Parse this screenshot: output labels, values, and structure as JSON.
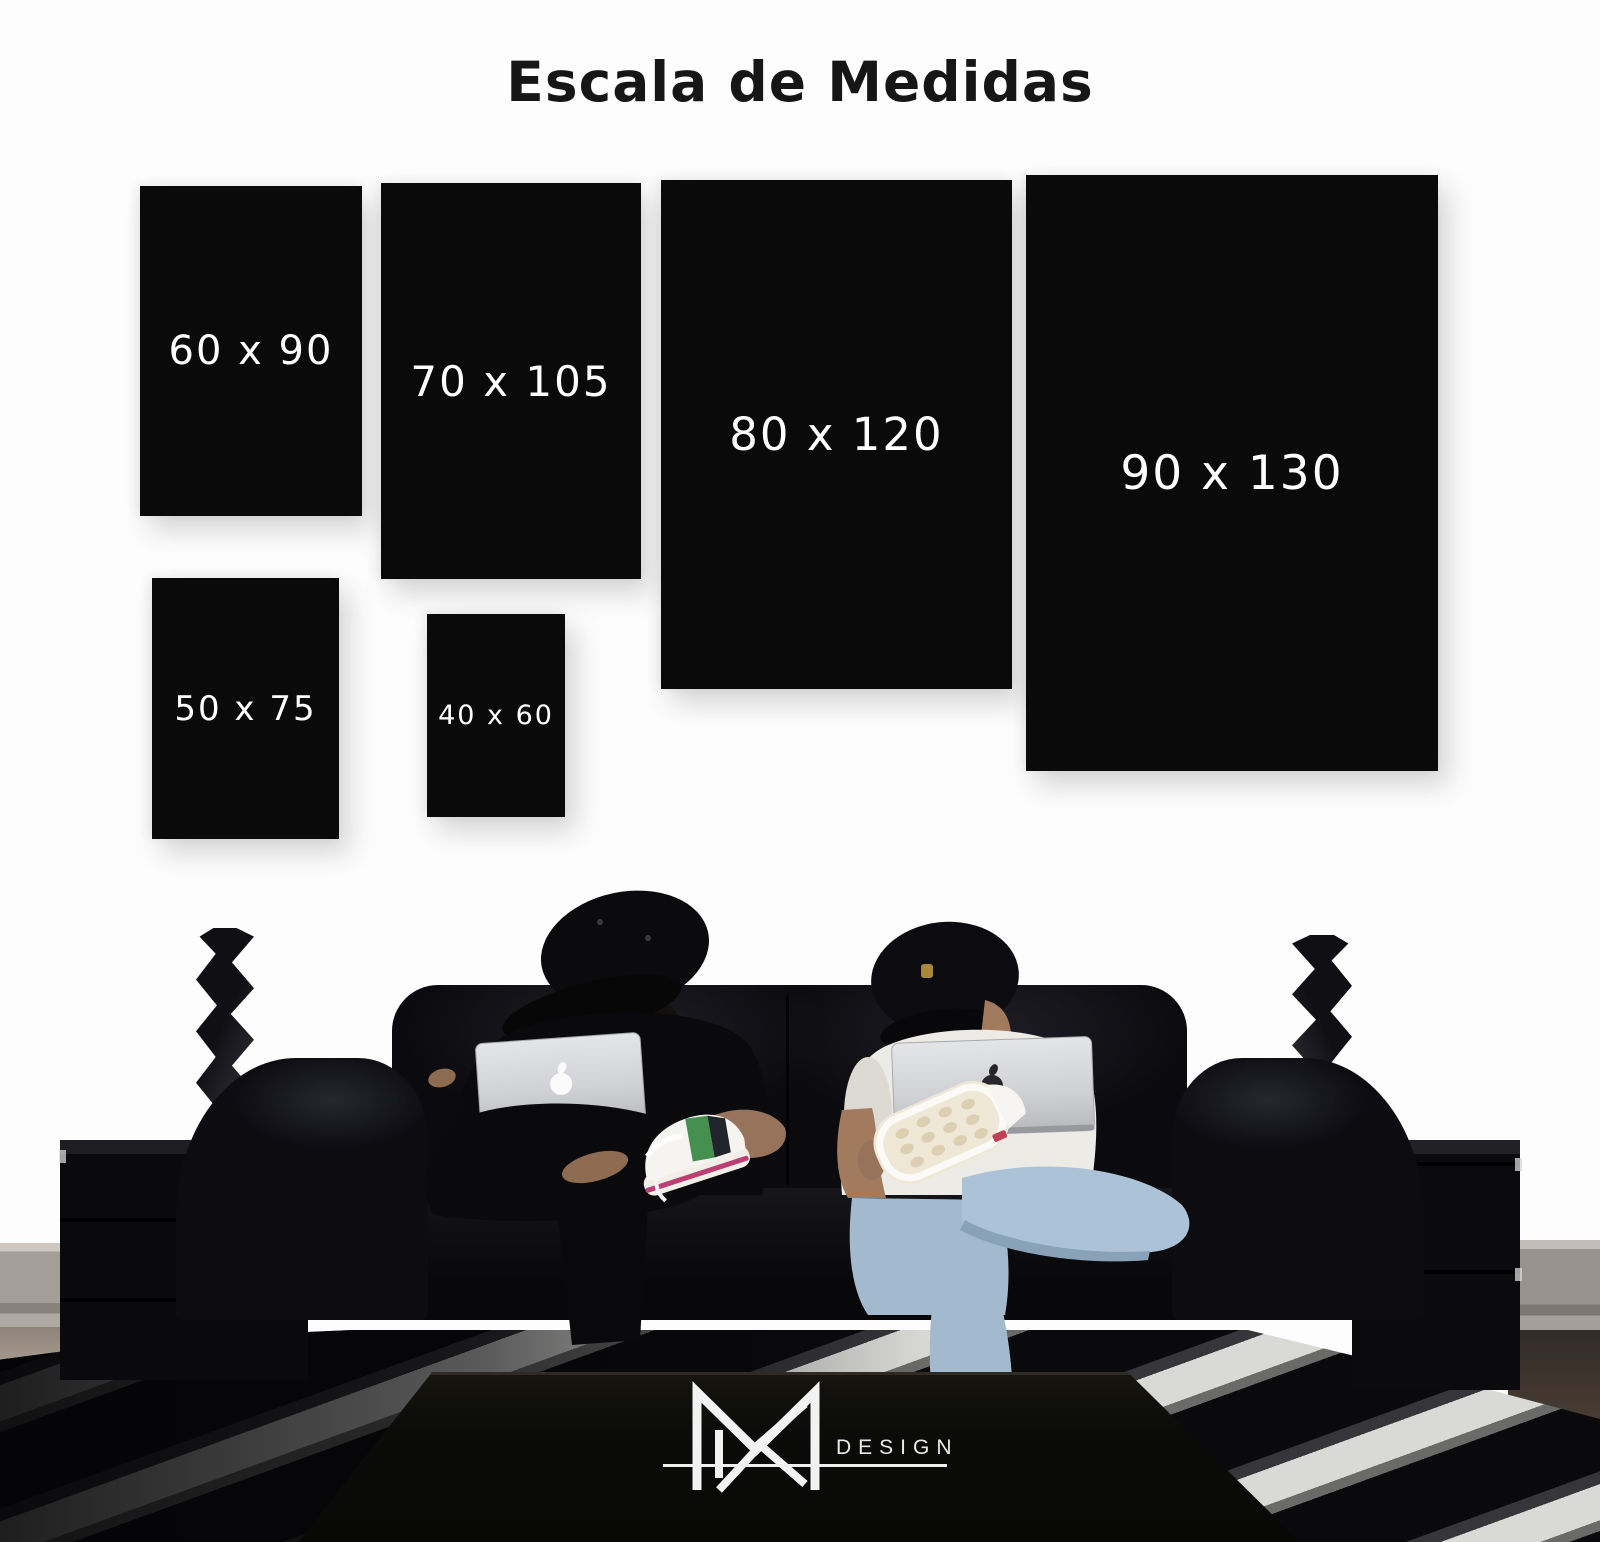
{
  "title": "Escala de Medidas",
  "sizes": [
    {
      "id": "60x90",
      "label": "60 x 90",
      "width_cm": 60,
      "height_cm": 90
    },
    {
      "id": "70x105",
      "label": "70 x 105",
      "width_cm": 70,
      "height_cm": 105
    },
    {
      "id": "80x120",
      "label": "80 x 120",
      "width_cm": 80,
      "height_cm": 120
    },
    {
      "id": "90x130",
      "label": "90 x 130",
      "width_cm": 90,
      "height_cm": 130
    },
    {
      "id": "50x75",
      "label": "50 x 75",
      "width_cm": 50,
      "height_cm": 75
    },
    {
      "id": "40x60",
      "label": "40 x 60",
      "width_cm": 40,
      "height_cm": 60
    }
  ],
  "brand": {
    "wordmark": "DESIGN",
    "monogram_icon": "mr-monogram"
  },
  "icons": {
    "apple_logo": "apple-silhouette",
    "cap_badge": "shield",
    "monogram": "mr-monogram"
  },
  "colors": {
    "background": "#fdfdfd",
    "panel": "#0a0a0a",
    "panel_label": "#ffffff",
    "title_text": "#161616",
    "logo": "#f2f2f2",
    "sofa_leather": "#0b0b0f",
    "jeans_blue": "#a9bfd2",
    "sneaker_green": "#45904f",
    "sneaker_pink": "#bb3f72"
  }
}
